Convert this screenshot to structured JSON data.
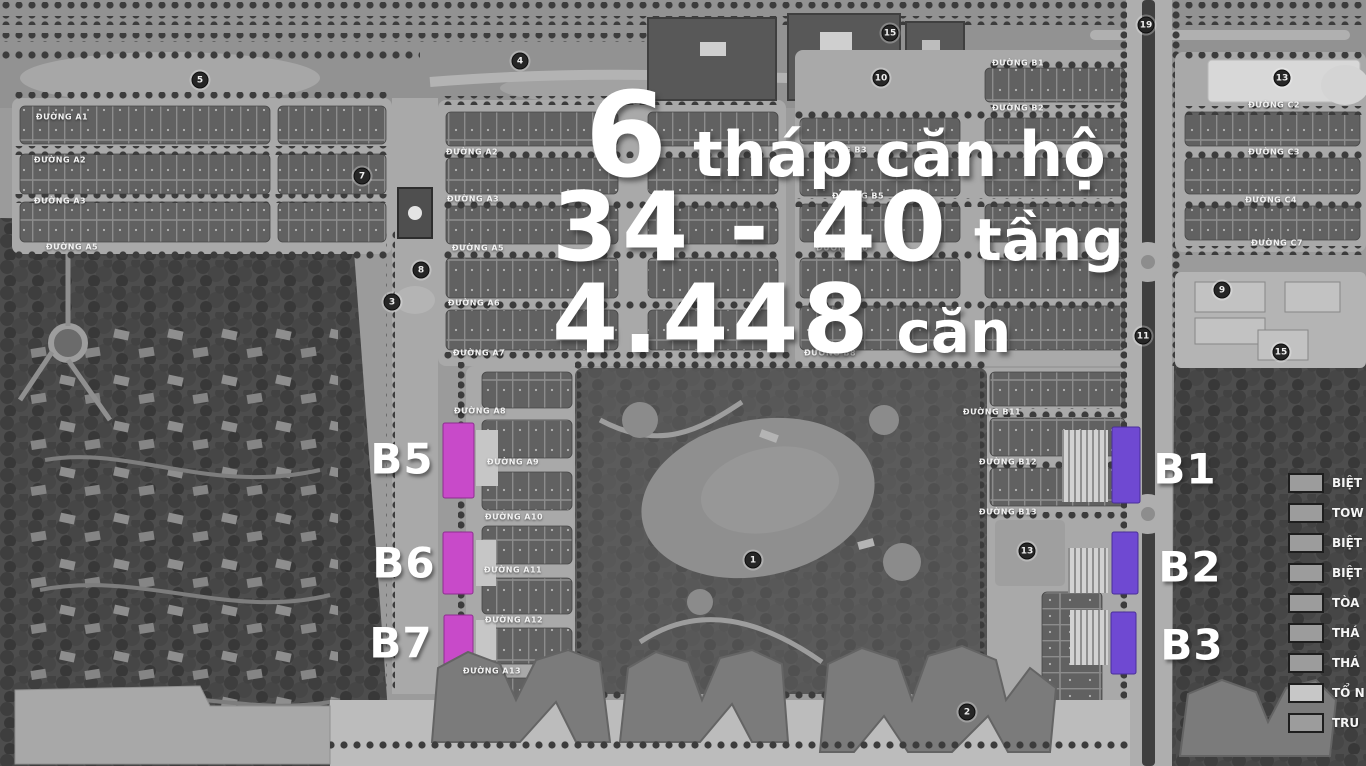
{
  "headline": {
    "line1_big": "6",
    "line1_rest": "tháp căn hộ",
    "line2_big": "34 - 40",
    "line2_small": "tầng",
    "line3_big": "4.448",
    "line3_small": "căn"
  },
  "block_labels": {
    "b5": "B5",
    "b6": "B6",
    "b7": "B7",
    "b1": "B1",
    "b2": "B2",
    "b3": "B3"
  },
  "streets": [
    {
      "label": "ĐƯỜNG A1"
    },
    {
      "label": "ĐƯỜNG A2"
    },
    {
      "label": "ĐƯỜNG A3"
    },
    {
      "label": "ĐƯỜNG A5"
    },
    {
      "label": "ĐƯỜNG A2"
    },
    {
      "label": "ĐƯỜNG A3"
    },
    {
      "label": "ĐƯỜNG A5"
    },
    {
      "label": "ĐƯỜNG A6"
    },
    {
      "label": "ĐƯỜNG A7"
    },
    {
      "label": "ĐƯỜNG A8"
    },
    {
      "label": "ĐƯỜNG A9"
    },
    {
      "label": "ĐƯỜNG A10"
    },
    {
      "label": "ĐƯỜNG A11"
    },
    {
      "label": "ĐƯỜNG A12"
    },
    {
      "label": "ĐƯỜNG A13"
    },
    {
      "label": "ĐƯỜNG B1"
    },
    {
      "label": "ĐƯỜNG B2"
    },
    {
      "label": "ĐƯỜNG B3"
    },
    {
      "label": "ĐƯỜNG B5"
    },
    {
      "label": "ĐƯỜNG B6"
    },
    {
      "label": "ĐƯỜNG B8"
    },
    {
      "label": "ĐƯỜNG B11"
    },
    {
      "label": "ĐƯỜNG B12"
    },
    {
      "label": "ĐƯỜNG B13"
    },
    {
      "label": "ĐƯỜNG C2"
    },
    {
      "label": "ĐƯỜNG C3"
    },
    {
      "label": "ĐƯỜNG C4"
    },
    {
      "label": "ĐƯỜNG C7"
    }
  ],
  "markers": [
    {
      "value": "5"
    },
    {
      "value": "4"
    },
    {
      "value": "15"
    },
    {
      "value": "10"
    },
    {
      "value": "19"
    },
    {
      "value": "13"
    },
    {
      "value": "7"
    },
    {
      "value": "8"
    },
    {
      "value": "3"
    },
    {
      "value": "11"
    },
    {
      "value": "9"
    },
    {
      "value": "15"
    },
    {
      "value": "13"
    },
    {
      "value": "1"
    },
    {
      "value": "2"
    }
  ],
  "legend": {
    "items": [
      {
        "label": "BIỆT"
      },
      {
        "label": "TOW"
      },
      {
        "label": "BIỆT"
      },
      {
        "label": "BIỆT"
      },
      {
        "label": "TÒA"
      },
      {
        "label": "THÁ"
      },
      {
        "label": "THÁ"
      },
      {
        "label": "TỔ N"
      },
      {
        "label": "TRU"
      }
    ]
  },
  "colors": {
    "magenta": "#c84ac9",
    "purple": "#6f49d2"
  }
}
